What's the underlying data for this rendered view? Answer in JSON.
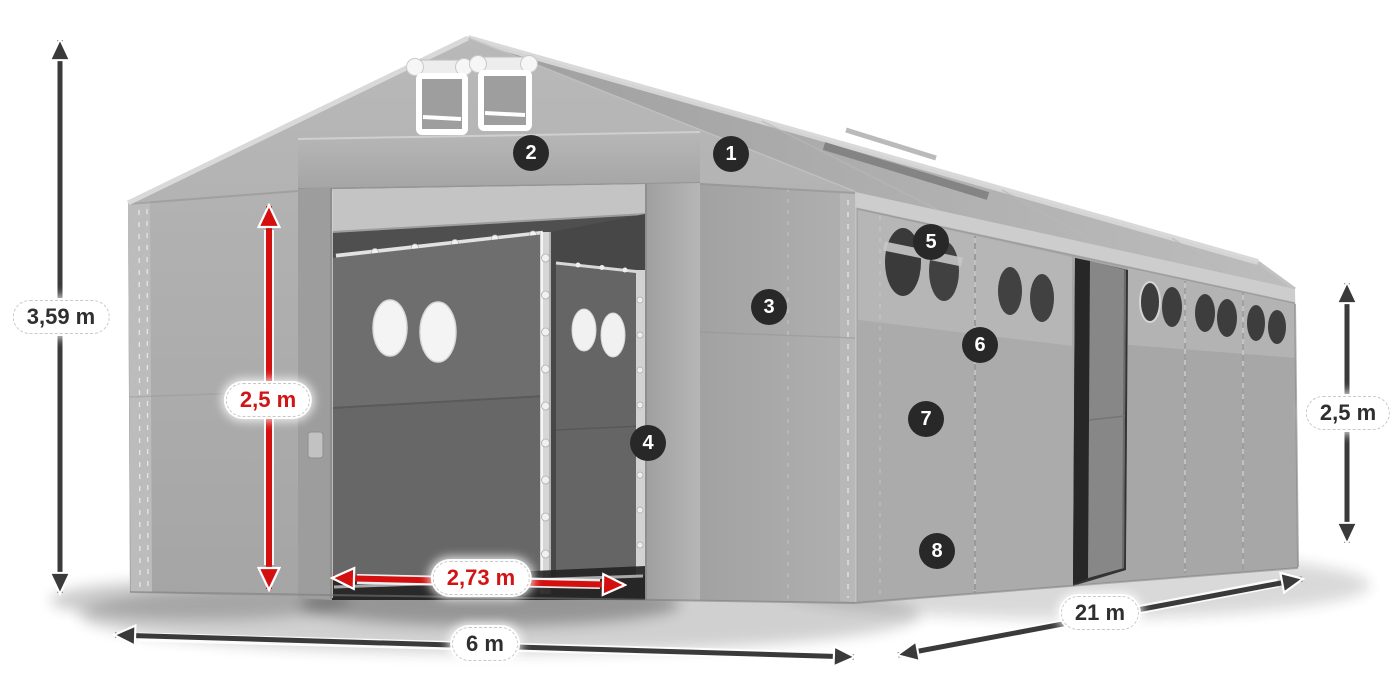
{
  "meta": {
    "description": "Dimension diagram of a gray PVC marquee / storage tent 6 m x 21 m, 3/4 perspective view with open front gates, side entrance and numbered feature callouts",
    "background": "#ffffff"
  },
  "callouts": [
    {
      "number": "1",
      "placement": "roof"
    },
    {
      "number": "2",
      "placement": "front-header"
    },
    {
      "number": "3",
      "placement": "front-right-wall"
    },
    {
      "number": "4",
      "placement": "front-door-column"
    },
    {
      "number": "5",
      "placement": "side-window-band"
    },
    {
      "number": "6",
      "placement": "side-wall-seam"
    },
    {
      "number": "7",
      "placement": "side-wall-upper"
    },
    {
      "number": "8",
      "placement": "side-wall-lower"
    }
  ],
  "dimensions": {
    "total_height": {
      "label": "3,59 m",
      "color": "dark"
    },
    "inner_height": {
      "label": "2,5 m",
      "color": "red"
    },
    "door_width": {
      "label": "2,73 m",
      "color": "red"
    },
    "front_width": {
      "label": "6 m",
      "color": "dark"
    },
    "side_length": {
      "label": "21 m",
      "color": "dark"
    },
    "side_wall_height": {
      "label": "2,5 m",
      "color": "dark"
    }
  },
  "colors": {
    "red_accent": "#d30f0f",
    "arrow_dark": "#3a3a3a",
    "badge_background": "#282828",
    "badge_text": "#ffffff",
    "label_text": "#2f2f2f",
    "tent_light": "#c9c9c9",
    "tent_mid": "#ababab",
    "tent_interior_dark": "#4f4f4f"
  }
}
